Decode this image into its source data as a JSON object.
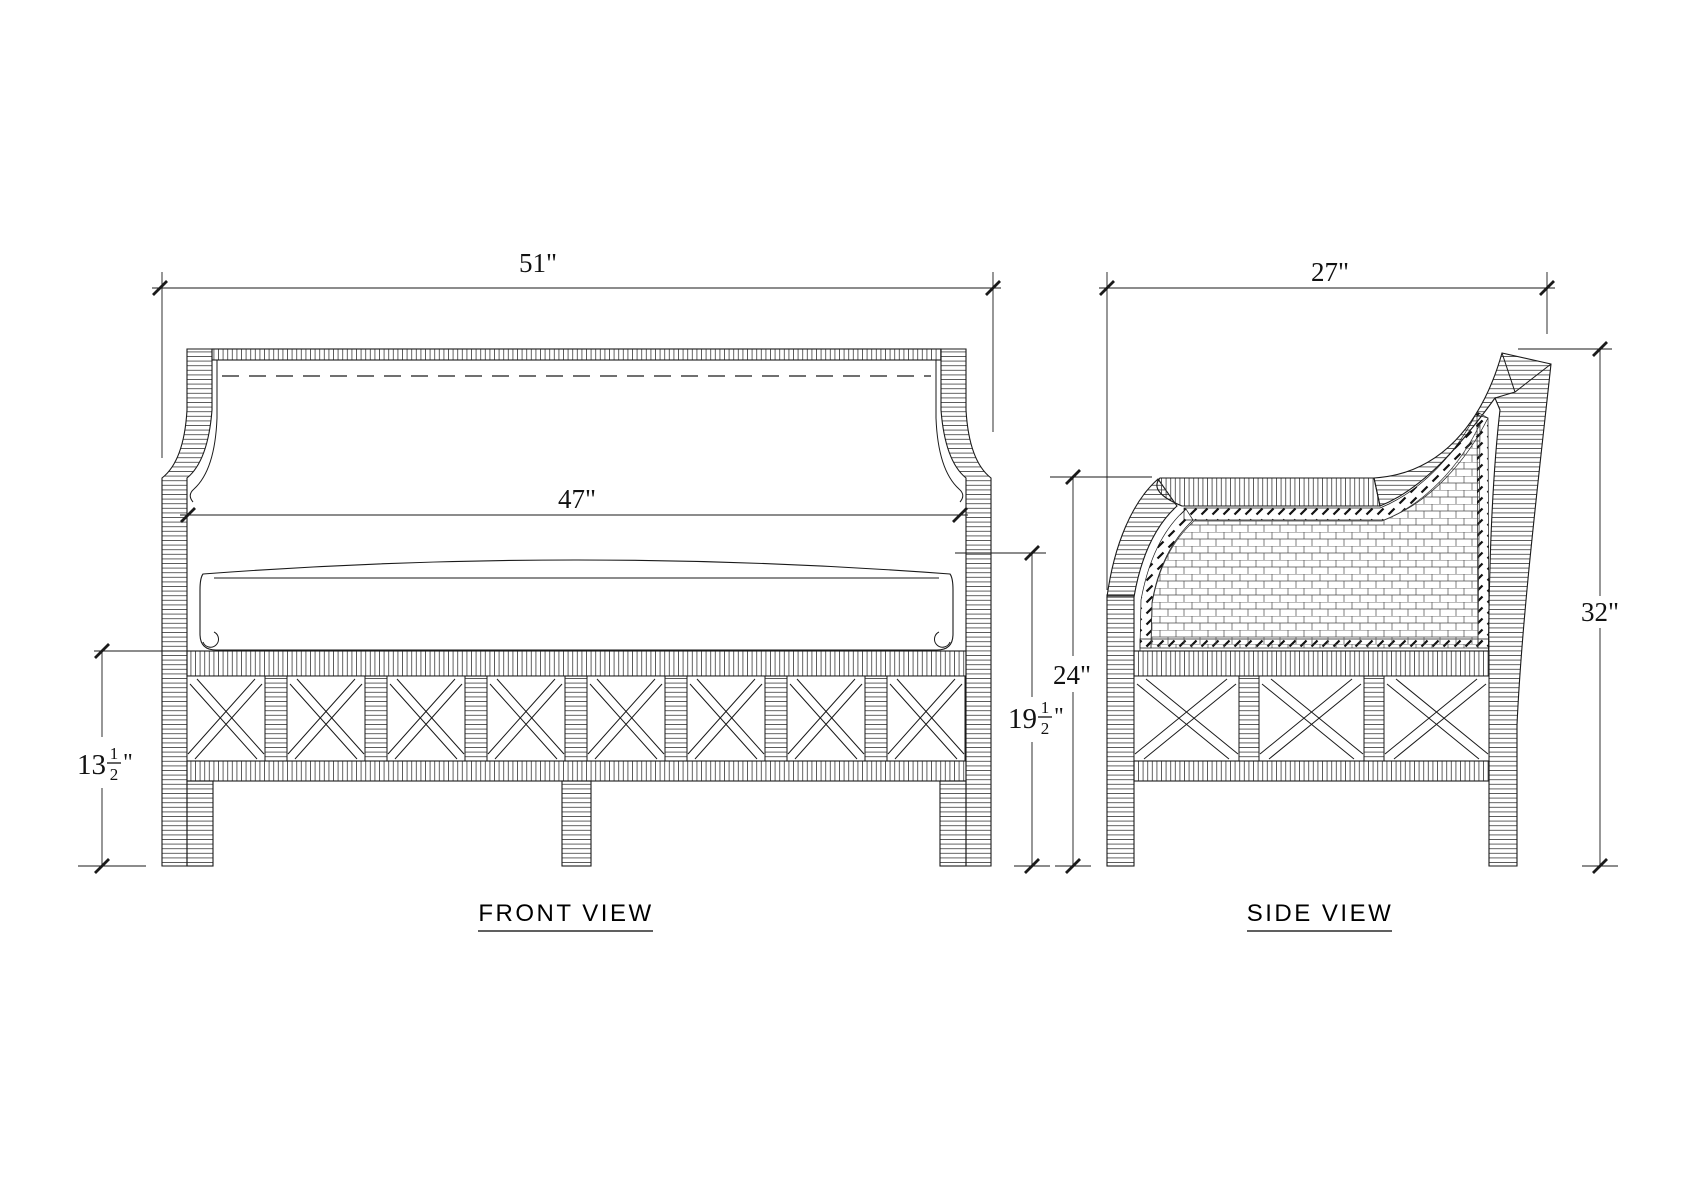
{
  "drawing": {
    "background": "#ffffff",
    "line_color": "#1a1a1a",
    "front_view": {
      "title": "FRONT VIEW",
      "dim_overall_width": "51\"",
      "dim_inner_width": "47\"",
      "dim_base_height": {
        "text": "13 1/2\"",
        "whole": "13",
        "numerator": "1",
        "denominator": "2",
        "unit": "\""
      },
      "dim_seat_height": {
        "text": "19 1/2\"",
        "whole": "19",
        "numerator": "1",
        "denominator": "2",
        "unit": "\""
      }
    },
    "side_view": {
      "title": "SIDE VIEW",
      "dim_depth": "27\"",
      "dim_arm_height": "24\"",
      "dim_overall_height": "32\""
    }
  }
}
